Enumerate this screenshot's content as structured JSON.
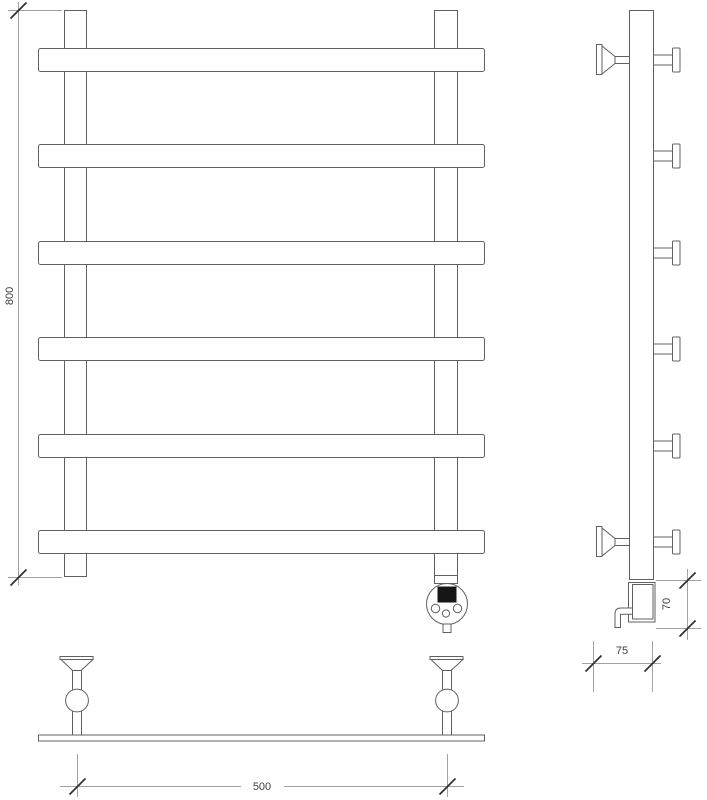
{
  "drawing": {
    "type": "heated-towel-rail-technical-drawing",
    "views": {
      "front": "front-view",
      "side": "side-view",
      "plan": "plan-view"
    },
    "dimensions": {
      "height": "800",
      "element_height": "70",
      "depth": "75",
      "width": "500"
    },
    "counts": {
      "towel_bars": 6,
      "wall_brackets_side": 2,
      "wall_brackets_plan": 2
    },
    "colors": {
      "background": "#ffffff",
      "outline": "#606060",
      "dimension_line": "#a2a2a2",
      "tick": "#2e2e2e",
      "label": "#3d3d3d",
      "display": "#161616"
    }
  }
}
